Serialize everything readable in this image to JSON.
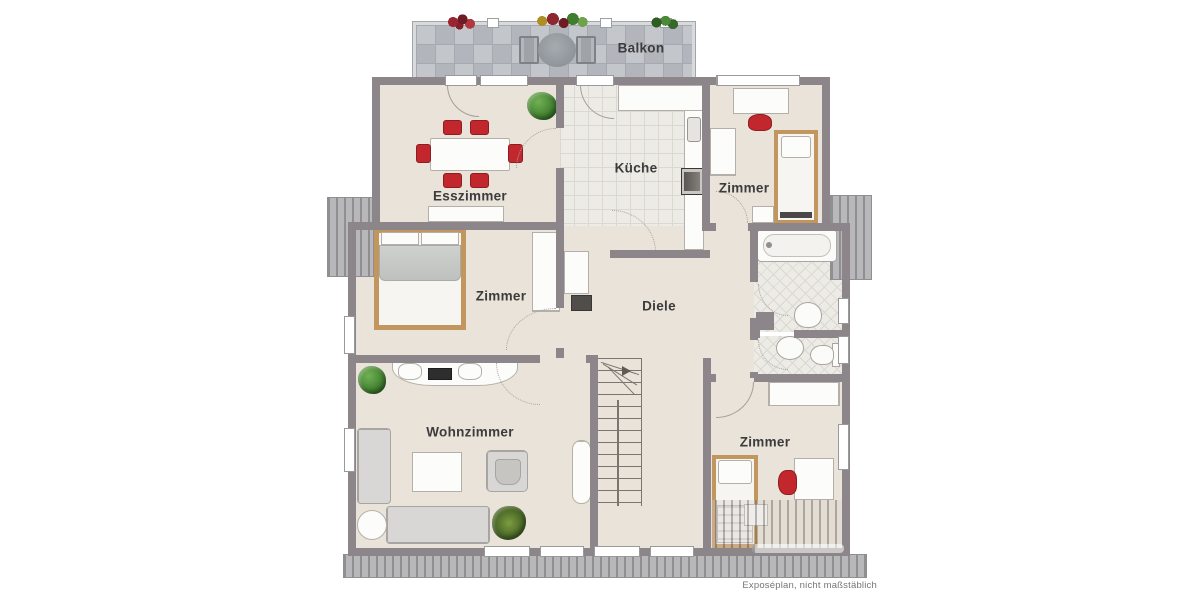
{
  "plan": {
    "type": "floorplan",
    "rooms": {
      "balkon": {
        "label": "Balkon"
      },
      "esszimmer": {
        "label": "Esszimmer"
      },
      "kueche": {
        "label": "Küche"
      },
      "zimmer_nordost": {
        "label": "Zimmer"
      },
      "zimmer_west": {
        "label": "Zimmer"
      },
      "diele": {
        "label": "Diele"
      },
      "wohnzimmer": {
        "label": "Wohnzimmer"
      },
      "zimmer_sued": {
        "label": "Zimmer"
      }
    },
    "footer": {
      "disclaimer": "Exposéplan, nicht maßstäblich"
    }
  },
  "colors": {
    "wall": "#8c8589",
    "floor": "#eae3d9",
    "tile": "#edebe6",
    "tile_line": "#dbd8d1",
    "hatch_bg": "#b8b8ba",
    "hatch_line": "#8f8f91",
    "accent_red": "#c1272d",
    "wood": "#c2965f",
    "text": "#3c3c3c"
  }
}
